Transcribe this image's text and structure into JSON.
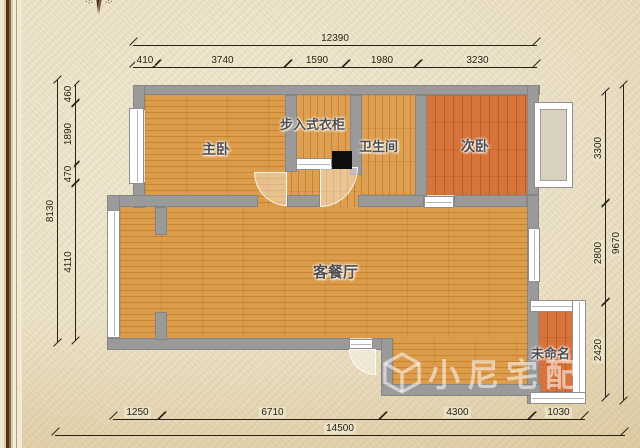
{
  "watermark": {
    "text": "小尼宅配",
    "logo_icon": "cube-logo-icon"
  },
  "compass": {
    "icon": "compass-north-icon"
  },
  "rooms": {
    "master": "主卧",
    "closet": "步入式衣柜",
    "bathroom": "卫生间",
    "second": "次卧",
    "living": "客餐厅",
    "unnamed": "未命名"
  },
  "dimensions": {
    "top_total": "12390",
    "top": [
      "410",
      "3740",
      "1590",
      "1980",
      "3230"
    ],
    "left_total": "8130",
    "left": [
      "460",
      "1890",
      "470",
      "4110"
    ],
    "right_total": "9670",
    "right": [
      "3300",
      "2800",
      "2420"
    ],
    "bottom": [
      "1250",
      "6710",
      "4300",
      "1030"
    ],
    "bottom_total": "14500"
  },
  "colors": {
    "wall": "#9a9a9a",
    "wood_light": "#d89845",
    "wood_red": "#cf6a33",
    "parchment": "#ece3c9",
    "dimension_ink": "#2a2218",
    "frame_brown": "#50331a",
    "column_black": "#0e0e0e"
  }
}
